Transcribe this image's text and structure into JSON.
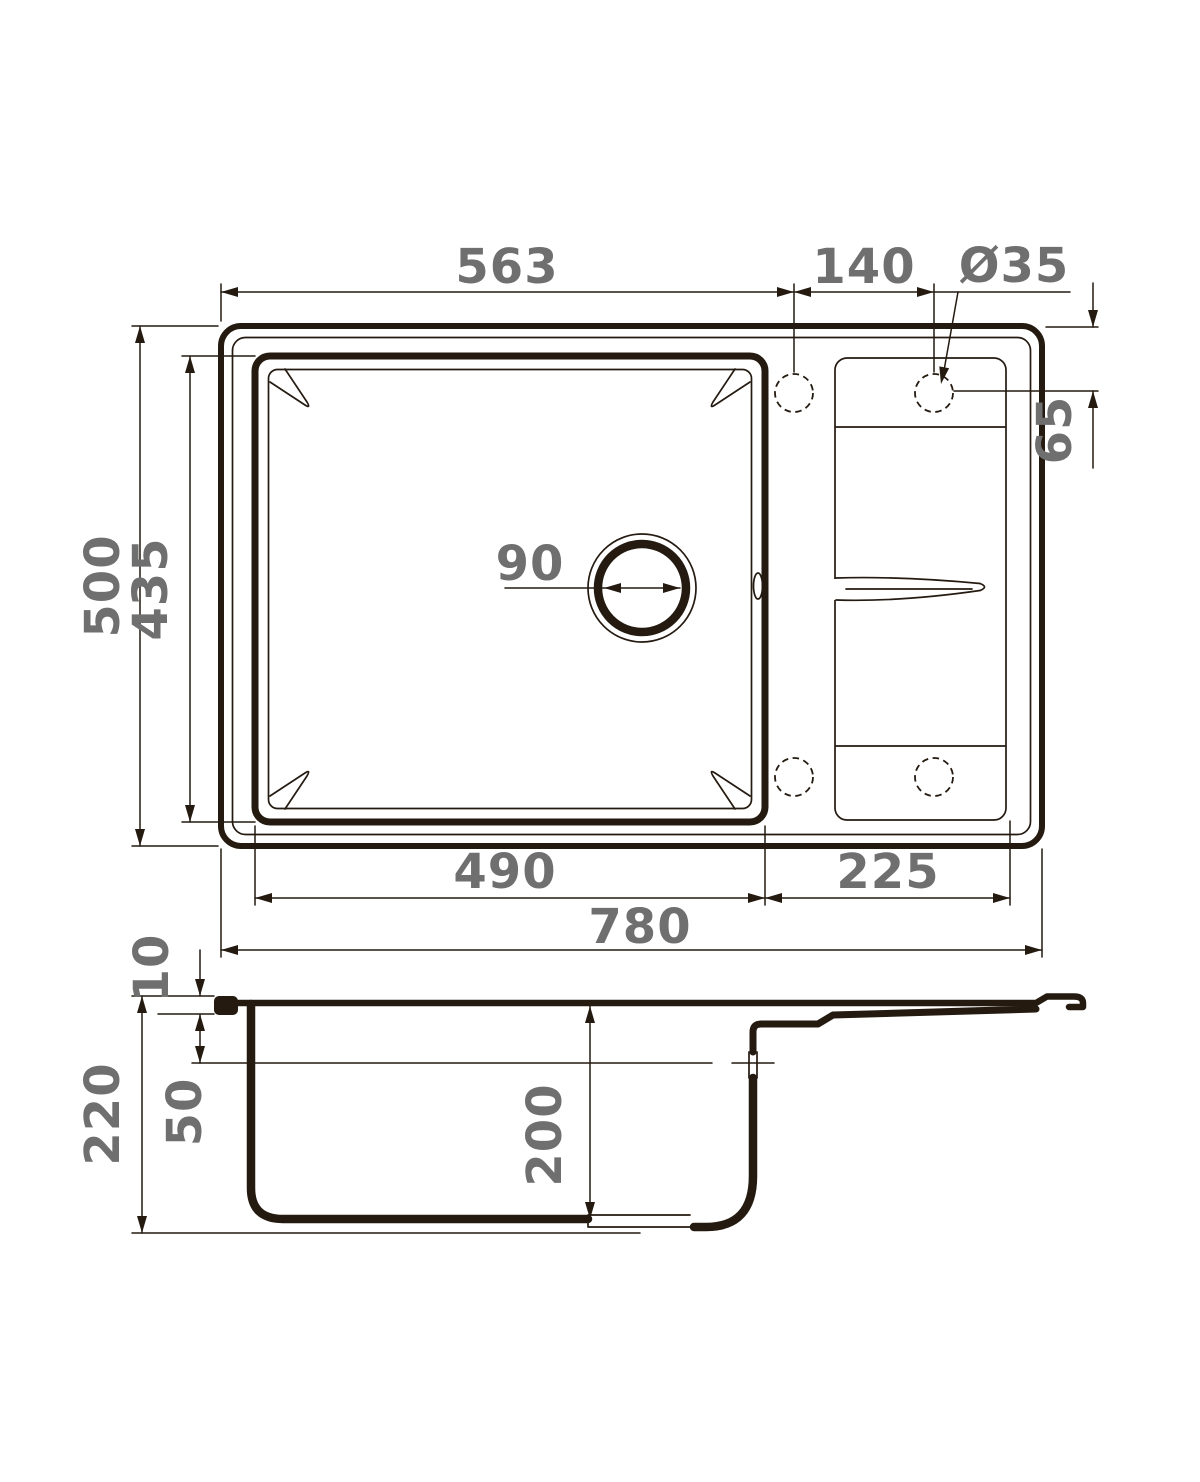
{
  "drawing": {
    "type": "technical-dimension-drawing",
    "subject": "kitchen sink with single bowl and drainboard, top view and section view",
    "units": "mm",
    "colors": {
      "line": "#241a10",
      "dim_text": "#6f6f6f",
      "background": "#ffffff"
    },
    "plan": {
      "edge_to_hole_width": "563",
      "hole_spacing": "140",
      "faucet_hole_diameter": "Ø35",
      "hole_edge_offset": "65",
      "overall_depth": "500",
      "bowl_opening_depth": "435",
      "drain_diameter": "90",
      "bowl_width": "490",
      "drainboard_width": "225",
      "overall_width": "780"
    },
    "section": {
      "rim_thickness": "10",
      "overall_height": "220",
      "overflow_drop": "50",
      "bowl_depth": "200"
    }
  }
}
